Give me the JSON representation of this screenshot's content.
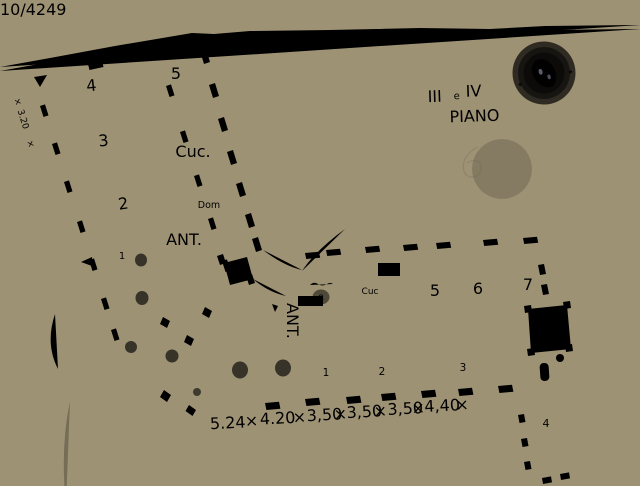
{
  "canvas": {
    "backing_color": "#b2a587",
    "paper_color": "#dcd5c3",
    "pencil_color": "#4a4338",
    "stamp_color": "#5748a6"
  },
  "header": {
    "mirrored_inscription": "10/4249",
    "floor_numeral_1": "III",
    "floor_conjunction": "e",
    "floor_numeral_2": "IV",
    "floor_word": "PIANO"
  },
  "plan": {
    "left_wing_rooms": {
      "r4": "4",
      "r5": "5",
      "r3": "3",
      "r2": "2",
      "r1": "1"
    },
    "left_wing_labels": {
      "cucina": "Cuc.",
      "dom": "Dom",
      "ant": "ANT."
    },
    "junction_labels": {
      "ant_vertical": "ANT."
    },
    "right_wing_top_rooms": {
      "r8": "8",
      "cuc": "Cuc",
      "r5": "5",
      "r6": "6",
      "r7": "7"
    },
    "right_wing_bottom_rooms": {
      "r1": "1",
      "r2": "2",
      "r3": "3",
      "r4": "4"
    },
    "dimensions": {
      "sep": "×",
      "tokens": [
        "5.24",
        "4.20",
        "3,50",
        "3,50",
        "3,50",
        "4,40"
      ],
      "left_vertical": "3.20"
    }
  }
}
